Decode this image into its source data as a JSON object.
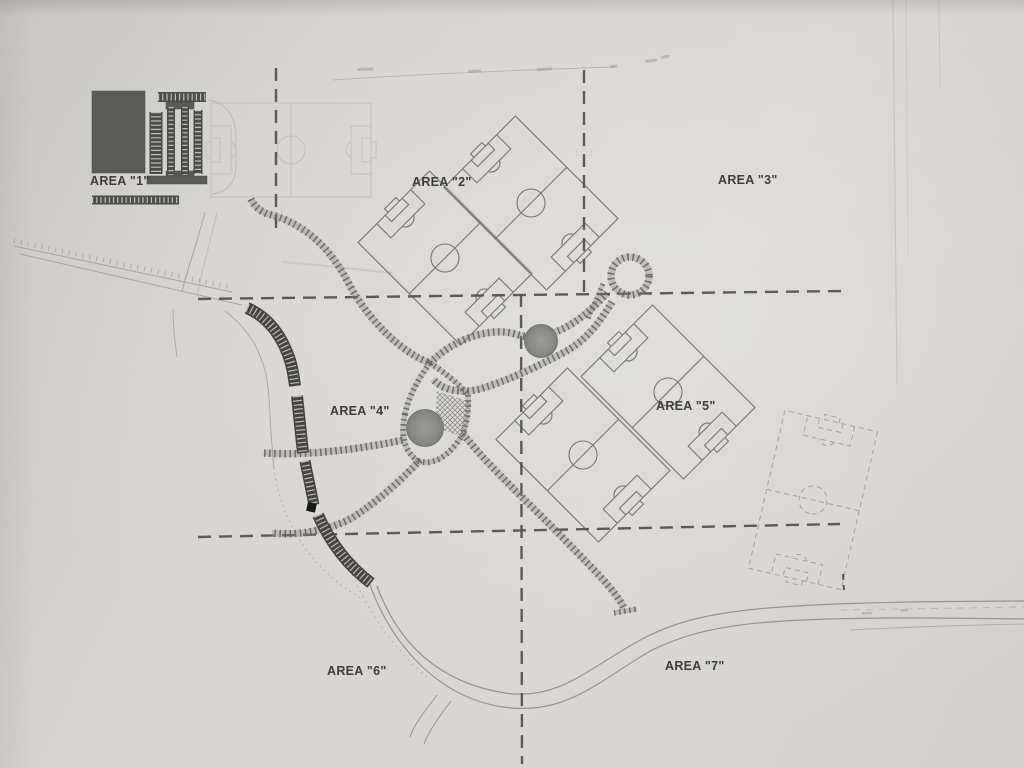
{
  "labels": [
    {
      "text": "AREA \"1\"",
      "x": 90,
      "y": 185
    },
    {
      "text": "AREA \"2\"",
      "x": 412,
      "y": 186
    },
    {
      "text": "AREA \"3\"",
      "x": 718,
      "y": 184
    },
    {
      "text": "AREA \"4\"",
      "x": 330,
      "y": 415
    },
    {
      "text": "AREA \"5\"",
      "x": 656,
      "y": 410
    },
    {
      "text": "AREA \"6\"",
      "x": 327,
      "y": 675
    },
    {
      "text": "AREA \"7\"",
      "x": 665,
      "y": 670
    }
  ],
  "colors": {
    "paper": "#d6d4d0",
    "ink_dark": "#454442",
    "ink_medium": "#76746e",
    "ink_faint": "#b7b5b1",
    "boundary": "#504f4d",
    "trail_rung": "#5e5d58",
    "pond": "#8b8b88",
    "building": "#5a5a58",
    "label_text": "#3e3d3b"
  },
  "plan": {
    "fields": [
      {
        "cx": 291,
        "cy": 150,
        "rot": 0,
        "L": 160,
        "W": 94,
        "stroke": "#c3c0ba",
        "width": 1
      },
      {
        "cx": 445,
        "cy": 258,
        "rot": 45,
        "L": 145,
        "W": 101,
        "stroke": "#76746e",
        "width": 1.1
      },
      {
        "cx": 531,
        "cy": 203,
        "rot": 45,
        "L": 145,
        "W": 101,
        "stroke": "#76746e",
        "width": 1.1
      },
      {
        "cx": 583,
        "cy": 455,
        "rot": 45,
        "L": 145,
        "W": 101,
        "stroke": "#76746e",
        "width": 1.1
      },
      {
        "cx": 668,
        "cy": 392,
        "rot": 45,
        "L": 145,
        "W": 101,
        "stroke": "#76746e",
        "width": 1.1
      },
      {
        "cx": 813,
        "cy": 500,
        "rot": 103,
        "L": 162,
        "W": 95,
        "stroke": "#a5a29b",
        "width": 1,
        "dash": "5 4"
      }
    ],
    "boundaries": [
      {
        "d": "M276,68 L276,230"
      },
      {
        "d": "M584,70 L584,292"
      },
      {
        "d": "M198,299 L843,291"
      },
      {
        "d": "M521,294 L522,764"
      },
      {
        "d": "M198,537 L840,524"
      },
      {
        "d": "M843,574 L844,590",
        "dash": "6 5",
        "w": 2
      }
    ],
    "trails": [
      {
        "d": "M251,199 C254,206 260,211 268,214 C305,223 331,249 349,284 C367,318 400,352 430,363"
      },
      {
        "d": "M430,363 C456,337 492,327 515,334 C537,341 560,333 579,319 C591,310 601,300 607,293"
      },
      {
        "d": "M649,276 A19,19 0 1 1 611,276 A19,19 0 1 1 649,276"
      },
      {
        "d": "M612,302 C600,322 586,341 563,353 C535,368 506,381 480,389 C460,394 442,390 433,379"
      },
      {
        "d": "M603,284 C598,296 592,308 588,319",
        "w": 4.5
      },
      {
        "d": "M430,363 C444,372 458,383 468,395",
        "w": 5.5
      },
      {
        "d": "M468,395 C469,410 467,421 463,434",
        "w": 5.5
      },
      {
        "d": "M430,363 C416,382 408,399 405,414",
        "w": 5.5
      },
      {
        "d": "M405,414 C400,437 405,452 418,461",
        "w": 5.5
      },
      {
        "d": "M418,461 C433,466 449,457 463,434",
        "w": 5.5
      },
      {
        "d": "M264,453 C310,456 360,449 403,440"
      },
      {
        "d": "M420,460 C396,486 372,505 352,518 C330,530 300,536 272,533"
      },
      {
        "d": "M463,434 C492,470 530,504 563,538 C593,569 615,590 624,608"
      },
      {
        "d": "M614,613 L637,609",
        "w": 5
      }
    ],
    "hatch": "437,391 471,402 465,438 435,427",
    "ponds": [
      {
        "cx": 541,
        "cy": 341,
        "r": 16.5
      },
      {
        "cx": 425,
        "cy": 428,
        "r": 18.5
      }
    ],
    "building": {
      "solids": [
        {
          "x": 92,
          "y": 91,
          "w": 53,
          "h": 82,
          "name": "building"
        },
        {
          "x": 166,
          "y": 102,
          "w": 28,
          "h": 7,
          "name": "parking-island-cap"
        },
        {
          "x": 166,
          "y": 171,
          "w": 28,
          "h": 7,
          "name": "parking-island-cap"
        },
        {
          "x": 147,
          "y": 176,
          "w": 60,
          "h": 8,
          "name": "parking-edge-bar"
        }
      ],
      "combs": [
        {
          "d": "M156,112 L156,174",
          "w": 13
        },
        {
          "d": "M171,107 L171,175",
          "w": 8
        },
        {
          "d": "M185,107 L185,175",
          "w": 8
        },
        {
          "d": "M198,110 L198,174",
          "w": 9
        },
        {
          "d": "M158,97 L206,97",
          "w": 10
        },
        {
          "d": "M92,200 L179,200",
          "w": 9
        }
      ]
    },
    "parking_strips": [
      {
        "d": "M247,308 C268,317 282,336 290,360 C293,370 294,378 295,386",
        "w": 12
      },
      {
        "d": "M297,396 C299,415 301,434 303,453",
        "w": 12
      },
      {
        "d": "M305,461 C308,476 311,491 314,505",
        "w": 11
      },
      {
        "d": "M318,515 C330,542 347,565 371,583",
        "w": 12
      }
    ],
    "marker": {
      "x": 308,
      "y": 502,
      "w": 9,
      "h": 9,
      "rot": 12
    },
    "roads": [
      {
        "d": "M377,586 C398,644 440,683 505,693 C559,701 588,668 644,638 C701,609 762,602 1025,601",
        "w": 1.2
      },
      {
        "d": "M366,573 C387,641 436,697 503,707 C567,716 598,681 652,650 C711,622 766,615 1025,619",
        "w": 1.2
      },
      {
        "d": "M437,695 C425,711 415,723 410,737",
        "w": 1
      },
      {
        "d": "M451,701 C438,718 429,731 424,744",
        "w": 1
      }
    ],
    "faint_lines": [
      {
        "d": "M333,80 C420,74 520,70 615,67",
        "s": "#b7b5b1",
        "w": 0.9
      },
      {
        "d": "M14,241 L230,287",
        "s": "#a5a3a0",
        "w": 5,
        "dash": "1 6",
        "o": 0.8
      },
      {
        "d": "M14,246 L232,292",
        "s": "#a8a6a2",
        "w": 1
      },
      {
        "d": "M20,254 L242,305",
        "s": "#a8a6a2",
        "w": 1
      },
      {
        "d": "M205,212 C197,243 188,268 182,291",
        "s": "#a8a6a2",
        "w": 1
      },
      {
        "d": "M217,213 C209,247 201,274 197,297",
        "s": "#b4b2ae",
        "w": 1,
        "o": 0.7
      },
      {
        "d": "M173,309 C173,327 175,342 177,357",
        "s": "#aaa8a4",
        "w": 1
      },
      {
        "d": "M225,311 C255,334 267,363 269,398 C271,432 272,452 274,468",
        "s": "#aaa8a4",
        "w": 1
      },
      {
        "d": "M274,468 C278,504 294,538 320,566 C334,581 349,591 362,599",
        "s": "#aaa8a4",
        "w": 1,
        "dash": "1.5 4"
      },
      {
        "d": "M345,558 C364,606 392,648 428,678",
        "s": "#a5a3a0",
        "w": 1.2,
        "dash": "1.5 4.5",
        "o": 0.8
      },
      {
        "d": "M208,100 C225,102 235,115 236,135 L236,165 C236,182 228,192 212,194",
        "s": "#b4b2ae",
        "w": 1,
        "o": 0.8
      },
      {
        "d": "M893,0 L897,385",
        "s": "#c8c6c2",
        "w": 1.2
      },
      {
        "d": "M906,0 L908,255",
        "s": "#cdcbc7",
        "w": 1
      },
      {
        "d": "M939,0 L940,88",
        "s": "#c8c6c2",
        "w": 1
      },
      {
        "d": "M840,610 L1024,607",
        "s": "#a8a6a2",
        "w": 1,
        "dash": "7 6",
        "o": 0.65
      },
      {
        "d": "M850,630 C930,626 980,625 1024,624",
        "s": "#b0aeaa",
        "w": 1
      },
      {
        "d": "M283,262 C320,265 355,269 392,273",
        "s": "#bbb9b5",
        "w": 2,
        "o": 0.5
      }
    ],
    "smudges": [
      {
        "x": 357,
        "y": 68,
        "w": 16,
        "h": 3,
        "rot": -2
      },
      {
        "x": 468,
        "y": 70,
        "w": 13,
        "h": 3,
        "rot": -2
      },
      {
        "x": 537,
        "y": 68,
        "w": 15,
        "h": 3,
        "rot": -3
      },
      {
        "x": 610,
        "y": 65,
        "w": 7,
        "h": 3,
        "rot": -3
      },
      {
        "x": 645,
        "y": 60,
        "w": 12,
        "h": 3,
        "rot": -8
      },
      {
        "x": 661,
        "y": 56,
        "w": 8,
        "h": 3,
        "rot": -10
      },
      {
        "x": 862,
        "y": 612,
        "w": 10,
        "h": 2.5,
        "rot": -1
      },
      {
        "x": 900,
        "y": 609,
        "w": 8,
        "h": 2.5,
        "rot": -1
      }
    ]
  }
}
